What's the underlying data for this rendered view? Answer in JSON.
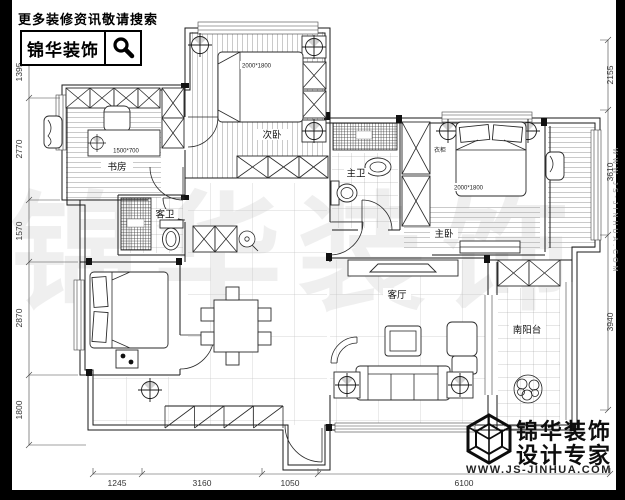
{
  "topbar": {
    "slogan": "更多装修资讯敬请搜索",
    "logo_text": "锦华装饰"
  },
  "brand": {
    "name": "锦华装饰",
    "tagline": "设计专家",
    "website": "WWW.JS-JINHUA.COM"
  },
  "watermark": {
    "text": "锦华装饰",
    "site": "WWW.JS-JINHUA.COM"
  },
  "rooms": {
    "secondary_bedroom": "次卧",
    "study": "书房",
    "guest_bath": "客卫",
    "master_bath": "主卫",
    "master_bedroom": "主卧",
    "living_room": "客厅",
    "south_balcony": "南阳台"
  },
  "labels": {
    "secondary_bed_size": "2000*1800",
    "master_bed_size": "2000*1800",
    "desk_size": "1500*700",
    "wardrobe": "衣柜"
  },
  "dimensions": {
    "left": [
      "1395",
      "2770",
      "1570",
      "2870",
      "1800"
    ],
    "right": [
      "2155",
      "3610",
      "3940"
    ],
    "bottom": [
      "1245",
      "3160",
      "1050",
      "6100"
    ]
  },
  "colors": {
    "line": "#1a1a1a",
    "frame": "#000000",
    "floor_stripe": "#b3b3b3",
    "tile_grid": "#9a9a9a"
  }
}
